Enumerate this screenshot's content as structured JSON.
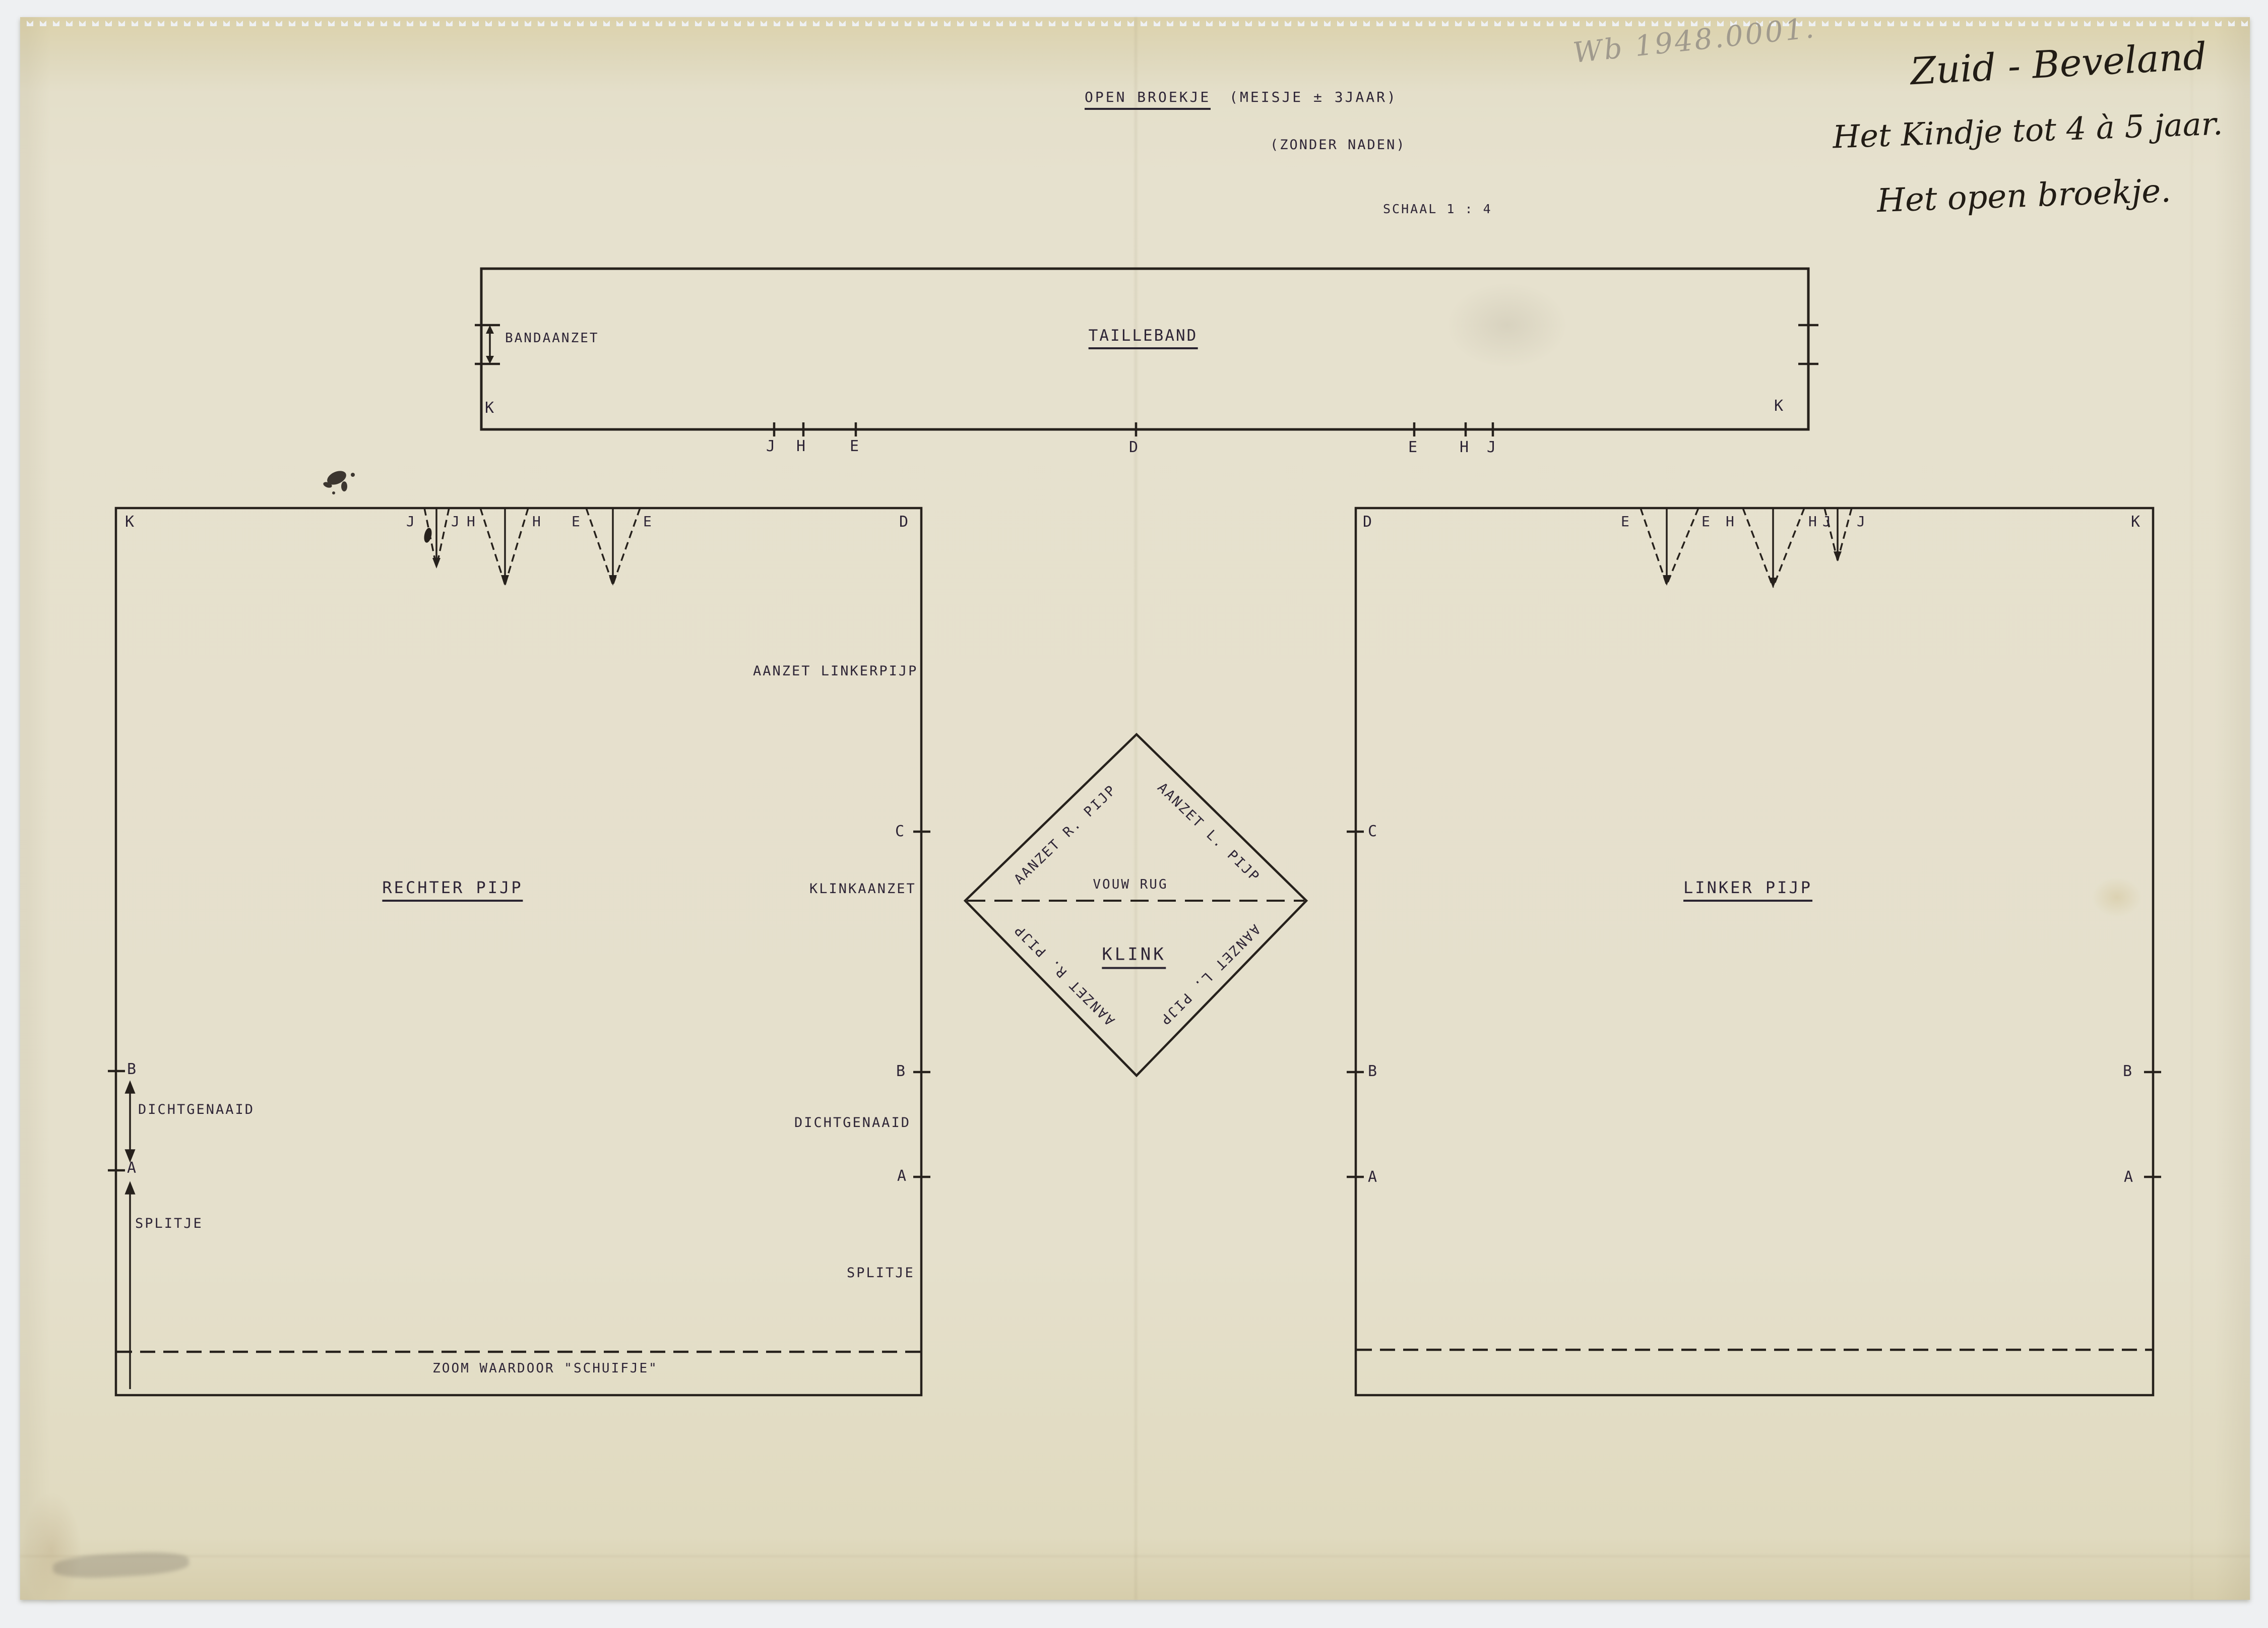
{
  "title": {
    "main": "OPEN BROEKJE",
    "suffix": "(MEISJE ± 3JAAR)",
    "sub": "(ZONDER NADEN)",
    "scale": "SCHAAL 1 : 4"
  },
  "handwriting": {
    "pencil_number": "Wb 1948.0001.",
    "line1": "Zuid - Beveland",
    "line2": "Het Kindje tot 4 à 5 jaar.",
    "line3": "Het open broekje."
  },
  "waistband": {
    "name": "TAILLEBAND",
    "attach": "BANDAANZET"
  },
  "right_leg": {
    "name": "RECHTER PIJP",
    "attach_left_leg": "AANZET LINKERPIJP",
    "gusset_attach": "KLINKAANZET",
    "sewn_shut": "DICHTGENAAID",
    "slit": "SPLITJE",
    "hem": "ZOOM WAARDOOR \"SCHUIFJE\""
  },
  "left_leg": {
    "name": "LINKER PIJP"
  },
  "gusset": {
    "name": "KLINK",
    "fold": "VOUW RUG",
    "attach_right": "AANZET R. PIJP",
    "attach_left": "AANZET L. PIJP"
  },
  "points": {
    "A": "A",
    "B": "B",
    "C": "C",
    "D": "D",
    "E": "E",
    "H": "H",
    "J": "J",
    "K": "K"
  },
  "colors": {
    "paper": "#e6e1ce",
    "ink_line": "#26211c",
    "type_ink": "#2e2536",
    "pencil": "#a09a8d",
    "scan_background": "#eef0f2"
  }
}
